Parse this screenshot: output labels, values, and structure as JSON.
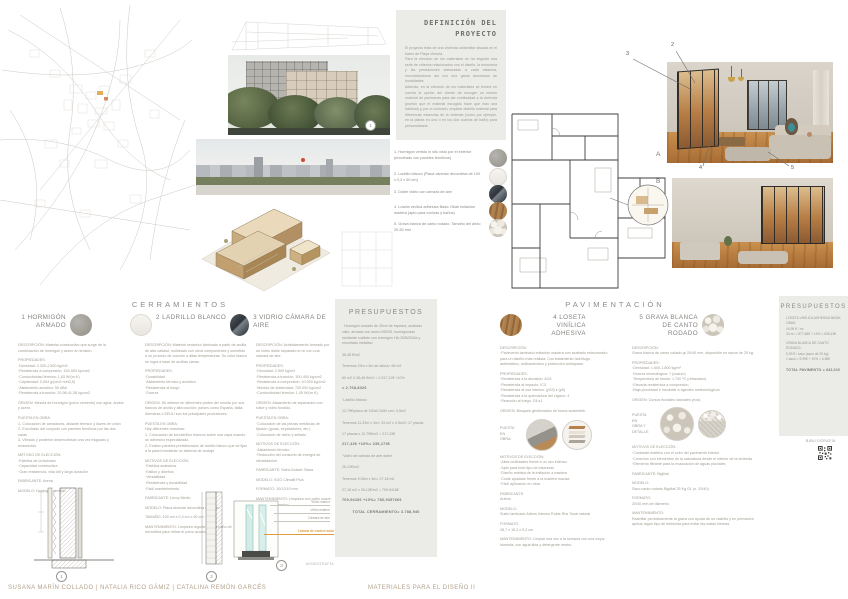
{
  "definicion": {
    "title": "DEFINICIÓN DEL PROYECTO",
    "body": "El proyecto trata de una vivienda unifamiliar situada en el barrio de Playa Victoria.\nPara la elección de los materiales se ha seguido una serie de criterios relacionados con el diseño, la economía y las prestaciones adecuadas a cada estancia, encontrándonos así con una gama armoniosa de tonalidades.\nAdemás, en la elección de los materiales se tendrá en cuenta la opción del cliente de escoger un mismo material de pavimento para dar continuidad a la vivienda (puesto que el material escogido hace que esto sea habitual) y, por el contrario, emplear distinto material para diferenciar estancias de la vivienda (como por ejemplo, en la planta en uno o en los dos cuartos de baño) para personalizarla."
  },
  "legend": {
    "items": [
      {
        "num": "1.",
        "text": "Hormigón vertido in situ visto por el exterior (encofrado con paneles fenólicos)"
      },
      {
        "num": "2.",
        "text": "Ladrillo blanco (Placa alveolar decorativa de 100 x 0,3 x 50 cm)"
      },
      {
        "num": "3.",
        "text": "Doble vidrio con cámara de aire"
      },
      {
        "num": "4.",
        "text": "Loseta vinílica adhesiva Basic Obak imitación madera (apto para cocinas y baños)"
      },
      {
        "num": "5.",
        "text": "Grava blanca de canto rodado. Tamaño del árido 20-50 mm"
      }
    ]
  },
  "annot": {
    "a": "A",
    "b": "B",
    "n1": "1",
    "n2": "2",
    "n3": "3",
    "n4": "4",
    "n5": "5"
  },
  "cerr": {
    "heading": "CERRAMIENTOS",
    "circ1": "1",
    "circ2": "2",
    "circ3": "3",
    "glass": {
      "interior": "Vidrio interior",
      "exterior": "Vidrio exterior",
      "camara": "Cámara de aire",
      "lamina": "Lámina de control solar"
    },
    "m1": {
      "num": "1",
      "title": "HORMIGÓN ARMADO",
      "desc": "DESCRIPCIÓN: Material constructivo que surge de la combinación de hormigón y acero en tensión.",
      "props": "PROPIEDADES:\n·Densidad: 2.300-2.500 kg/m3\n·Resistencia a compresión: 150-500 kp/cm2\n·Conductividad térmica: 1,63 W/(m·K)\n·Capilaridad: 0,054 g/(cm2·min0,5)\n·Aislamiento acústico: 50 dBA\n·Resistencia a tracción: 20,98-41,38 kg/cm2",
      "origen": "ORIGEN: Mezcla de hormigón (polvo cemento) con agua, áridos y acero.",
      "puesta": "PUESTA EN OBRA:\n1- Colocación de armaduras, aislante térmico y llaves de unión\n2- Encofrado del conjunto con paneles fenólicos por las dos caras\n3- Vibrado y posterior desencofrado una vez fraguado y endurecido",
      "motivos": "MÉTODO DE ELECCIÓN:\n·Estética de la fachada\n·Capacidad constructiva\n·Gran resistencia, vida útil y larga duración",
      "fabricante": "FABRICANTE: Arena",
      "modelo": "MODELO: Hormigón armado"
    },
    "m2": {
      "num": "2",
      "title": "LADRILLO BLANCO",
      "desc": "DESCRIPCIÓN: Material cerámico fabricado a partir de arcilla de alta calidad, moldeado con otros componentes y sometido a un proceso de cocción a altas temperaturas. Su color blanco se logra a base de arcillas claras.",
      "props": "PROPIEDADES:\n·Durabilidad\n·Aislamiento térmico y acústico\n·Resistencia al fuego\n·Dureza",
      "origen": "ORIGEN: Se obtiene en diferentes partes del mundo por sus bancos de arcilla y alta cocción; países como España, Italia, Alemania o EEUU son los principales productores.",
      "puesta": "PUESTA EN OBRA:\nHay diferentes maneras:\n1- Colocación de los ladrillos blancos sobre una capa usando un adhesivo especializado.\n2- Existen paneles prefabricados de ladrillo blanco que se fijan a la pared mediante un sistema de anclaje.",
      "motivos": "MOTIVOS DE ELECCIÓN:\n·Estética acabados\n·Estilos y diseños\n·Versatilidad\n·Resistencia y durabilidad\n·Fácil mantenimiento",
      "fabricante": "FABRICANTE: Leroy Merlin",
      "modelo": "MODELO: Placa alveolar decorativa de panel",
      "tamano": "TAMAÑO: 100 cm x 0,3 cm x 50 cm",
      "mantenimiento": "MANTENIMIENTO: Limpieza regular con un paño de microfibra para retirar el polvo acumulado."
    },
    "m3": {
      "num": "3",
      "title": "VIDRIO CÁMARA DE AIRE",
      "desc": "DESCRIPCIÓN: Acristalamiento formado por un vidrio doble separado en sí con una cámara de aire.",
      "props": "PROPIEDADES:\n·Densidad: 2.500 kg/m3\n·Resistencia a tracción: 300-400 kg/cm2\n·Resistencia a compresión: 10.000 kg/cm2\n·Módulo de elasticidad: 720.000 kg/cm2\n·Conductividad térmica: 1,05 W/(m·K)",
      "origen": "ORIGEN: Aislamiento de separación con sílice y vidrio fundido.",
      "puesta": "PUESTA EN OBRA:\n·Colocación de las piezas metálicas de fijación (guías, separadores, etc.)\n·Colocación de vidrio y sellado",
      "motivos": "MOTIVOS DE ELECCIÓN:\n·Aislamiento térmico\n·Reducción del consumo de energía de climatización",
      "fabricante": "FABRICANTE: Saint-Gobain Glass",
      "modelo": "MODELO: SGG Climalit Plus",
      "formato": "FORMATO: 10/12/10 mm",
      "mantenimiento": "MANTENIMIENTO: Limpieza con paño suave, agua y jabón neutro."
    }
  },
  "pc": {
    "title": "PRESUPUESTOS",
    "hormigon": "· Hormigón armado de 30cm de espesor, acabado visto, armado con acero B500S, hormigonado mediante cubilote con hormigón HA-30/B/20/IIa y encofrado metálico:\n\n36,48 €/m2\n\nTenemos 23m x 3m de altura= 69 m2\n\n69 m2 X 36,48 €/m2 = 2.517,12€ +10%",
    "hormigon_total": "= 2.768,832€",
    "ladrillo": "·Ladrillo blanco:\n\n12,79€/placa de 100x0,3x50 cm= 0,5m2\n\nTenemos 11,33m x 3m= 34 m2 x 0,5m2= 17 placas\n\n17 placas x 12,79€/m2 = 217,43€",
    "ladrillo_total": "217,43€ +10%= 239,173€",
    "vidrio": "·Vidrio de cámara de aire doble\n\n26,12€/m2\n\nTenemos 9,06m x 3m= 27,18 m2\n\n27,18 m2 x 26,12€/m2 = 709,9416€",
    "vidrio_total": "709,9416€ +10%= 780,935766€",
    "total": "TOTAL CERRAMIENTO= 3.788,94€"
  },
  "pav": {
    "heading": "PAVIMENTACIÓN",
    "m4": {
      "num": "4",
      "title": "LOSETA VINÍLICA ADHESIVA",
      "desc": "DESCRIPCIÓN:\n·Pavimento laminado imitación madera con acabado estructurado para un diseño más realista. Con tratamiento hidrófugo, antiestático, antibacteriano y protección antirayado.",
      "props": "PROPIEDADES:\n·Resistencia a la abrasión: AC5\n·Resistencia al impacto: IC3\n·Resistencia al uso intenso: (p33) k (p5)\n·Resistencia a la quemadura del cigarro: 4\n·Reacción al fuego: Cfl-s1",
      "origen": "ORIGEN: Bosques gestionados de forma sostenible.",
      "puesta_label": "PUESTA\nEN\nOBRA:",
      "motivos": "MOTIVOS DE ELECCIÓN:\n·Altas cualidades frente a un uso intenso\n·Apto para todo tipo de estancias\n·Diseño realista de la imitación a madera\n·Coste ajustado frente a la madera maciza\n·Fácil aplicación en obra",
      "fabricante": "FABRICANTE:\nArtens",
      "modelo": "MODELO:\nSuelo laminado Artens Intenso Roble Rus Tosal natural",
      "formato": "FORMATO:\n28,7 x 19,2 x 0,2 cm",
      "mantenimiento": "MANTENIMIENTO: Limpiar una vez a la semana con una mopa húmeda, con agua tibia y detergente neutro."
    },
    "m5": {
      "num": "5",
      "title": "GRAVA BLANCA DE CANTO RODADO",
      "desc": "DESCRIPCIÓN:\nGrava blanca de canto rodado gr 20/40 mm, disponible en sacos de 25 kg.",
      "props": "PROPIEDADES:\n·Densidad: 1.600-1.800 kg/m³\n·Dureza mineralógica: 7 (cuarzo)\n·Temperatura de fusión: 1.700 ºC (refractario)\n·Elevada resistencia a compresión\n·Baja porosidad e insoluble a agentes meteorológicos",
      "origen": "ORIGEN: Cursos fluviales naturales (ríos)",
      "puesta_label": "PUESTA\nEN\nOBRA Y\nDETALLE:",
      "motivos": "MOTIVOS DE ELECCIÓN:\n·Contraste estético con el color del pavimento interior\n·Conexión con elementos de la naturaleza desde el interior de la vivienda\n·Elemento filtrante para la evacuación de aguas pluviales",
      "fabricante": "FABRICANTE: BigMat",
      "modelo": "MODELO:\nSaco canto rodado BigMat 25 Kg GL (n. 20/40)",
      "formato": "FORMATO:\n20/40 mm de diámetro",
      "mantenimiento": "MANTENIMIENTO:\nRastrillar periódicamente la grava con ayuda de un rastrillo y en primavera aplicar algún tipo de herbicida para evitar las malas hierbas."
    }
  },
  "pp": {
    "title": "PRESUPUESTOS",
    "loseta": "LOSETA VINÍLICA ADHESIVA BASIK OBAK:\n16,99 € / m²\n34 m² = 577,66€ + 10% = 635,43€",
    "grava": "GRAVA BLANCA DE CANTO RODADO:\n5,99 € / saco (saco de 25 kg)\n1 saco = 5,99€ + 10% = 6,58€",
    "total": "TOTAL PAVIMENTO = 642,01€"
  },
  "bibliografia": "BIBLIOGRAFÍA",
  "monografia": "MONOGRAFÍA",
  "footer": {
    "authors": "SUSANA MARÍN COLLADO | NATALIA RICO GÁMIZ | CATALINA REMÓN GARCÉS",
    "course": "MATERIALES PARA EL DISEÑO II"
  },
  "colors": {
    "accent": "#DD9B3F",
    "panel": "#EBEBE8"
  }
}
